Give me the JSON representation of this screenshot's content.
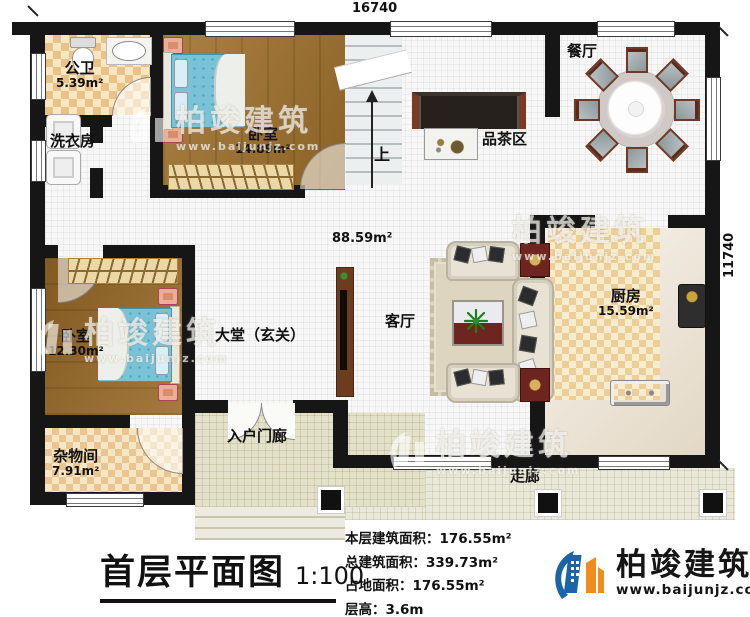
{
  "dimensions": {
    "top": "16740",
    "right": "11740"
  },
  "labels": {
    "gongwei": {
      "name": "公卫",
      "area": "5.39m²"
    },
    "xiyifang": {
      "name": "洗衣房"
    },
    "woshi1": {
      "name": "卧室",
      "area": "14.89m²"
    },
    "shang": {
      "name": "上"
    },
    "canting": {
      "name": "餐厅"
    },
    "pinchaqu": {
      "name": "品茶区"
    },
    "hall": {
      "area": "88.59m²"
    },
    "chufang": {
      "name": "厨房",
      "area": "15.59m²"
    },
    "keting": {
      "name": "客厅"
    },
    "datang": {
      "name": "大堂（玄关）"
    },
    "woshi2": {
      "name": "卧室",
      "area": "12.30m²"
    },
    "zawujian": {
      "name": "杂物间",
      "area": "7.91m²"
    },
    "rumenlang": {
      "name": "入户门廊"
    },
    "zoulang": {
      "name": "走廊"
    }
  },
  "title_block": {
    "title": "首层平面图",
    "scale": "1:100",
    "stats": [
      {
        "label": "本层建筑面积：",
        "value": "176.55m²"
      },
      {
        "label": "总建筑面积：",
        "value": "339.73m²"
      },
      {
        "label": "占地面积：",
        "value": "176.55m²"
      },
      {
        "label": "层高：",
        "value": "3.6m"
      }
    ]
  },
  "branding": {
    "name": "柏竣建筑",
    "url": "www.baijunjz.com"
  },
  "colors": {
    "wall": "#161616",
    "wood": "#a1722d",
    "bed": "#7ac2d8",
    "brand_blue": "#1c63a8",
    "brand_orange": "#f08c1e",
    "accent_red": "#6e2520"
  }
}
